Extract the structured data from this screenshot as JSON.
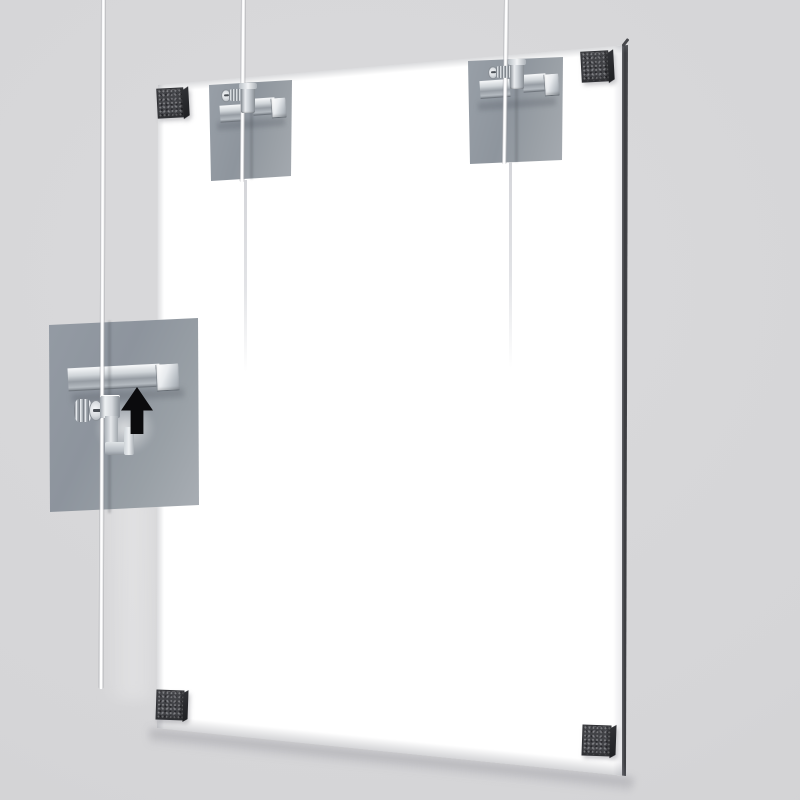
{
  "scene": {
    "description": "3D product render of a cable-suspension hanging kit: a clear acrylic panel hung on steel cables against a light gray wall, with an enlarged callout of the cable gripper and an upward assembly-direction arrow",
    "arrow_direction": "up",
    "text_content": "none"
  },
  "counts": {
    "cables": 3,
    "corner_grips": 4,
    "wall_mounts": 2,
    "callouts": 1
  },
  "parts": {
    "wall": "wall background",
    "panel": "clear acrylic display panel",
    "panel_edge": "panel right edge (panel thickness)",
    "cable_left": "left suspension cable",
    "cable_middle": "middle suspension cable",
    "cable_right": "right suspension cable",
    "mount_top_left": "top-left cable mount plate with gripper",
    "mount_top_right": "top-right cable mount plate with gripper",
    "detail": "zoomed detail of cable gripper assembly",
    "rail": "chrome gripper rail",
    "thumbscrew": "knurled locking thumbscrew",
    "gripper": "cable gripper hook",
    "arrow": "upward direction arrow",
    "corner_tl": "top-left corner grip block",
    "corner_tr": "top-right corner grip block",
    "corner_bl": "bottom-left corner grip block",
    "corner_br": "bottom-right corner grip block"
  },
  "palette": {
    "wall": "#d5d5d7",
    "panel": "#ffffff",
    "panel-edge": "#3a3b3f",
    "plate": "#99a0a8",
    "plate-light": "#a6abb1",
    "chrome-hi": "#f2f4f6",
    "chrome-mid": "#b4bac0",
    "chrome-dark": "#878d94",
    "cube": "#424347",
    "cube-side": "#1f2023",
    "cable": "#ffffff",
    "cable-faint": "#e2e3e6",
    "arrow": "#0b0b0d"
  }
}
